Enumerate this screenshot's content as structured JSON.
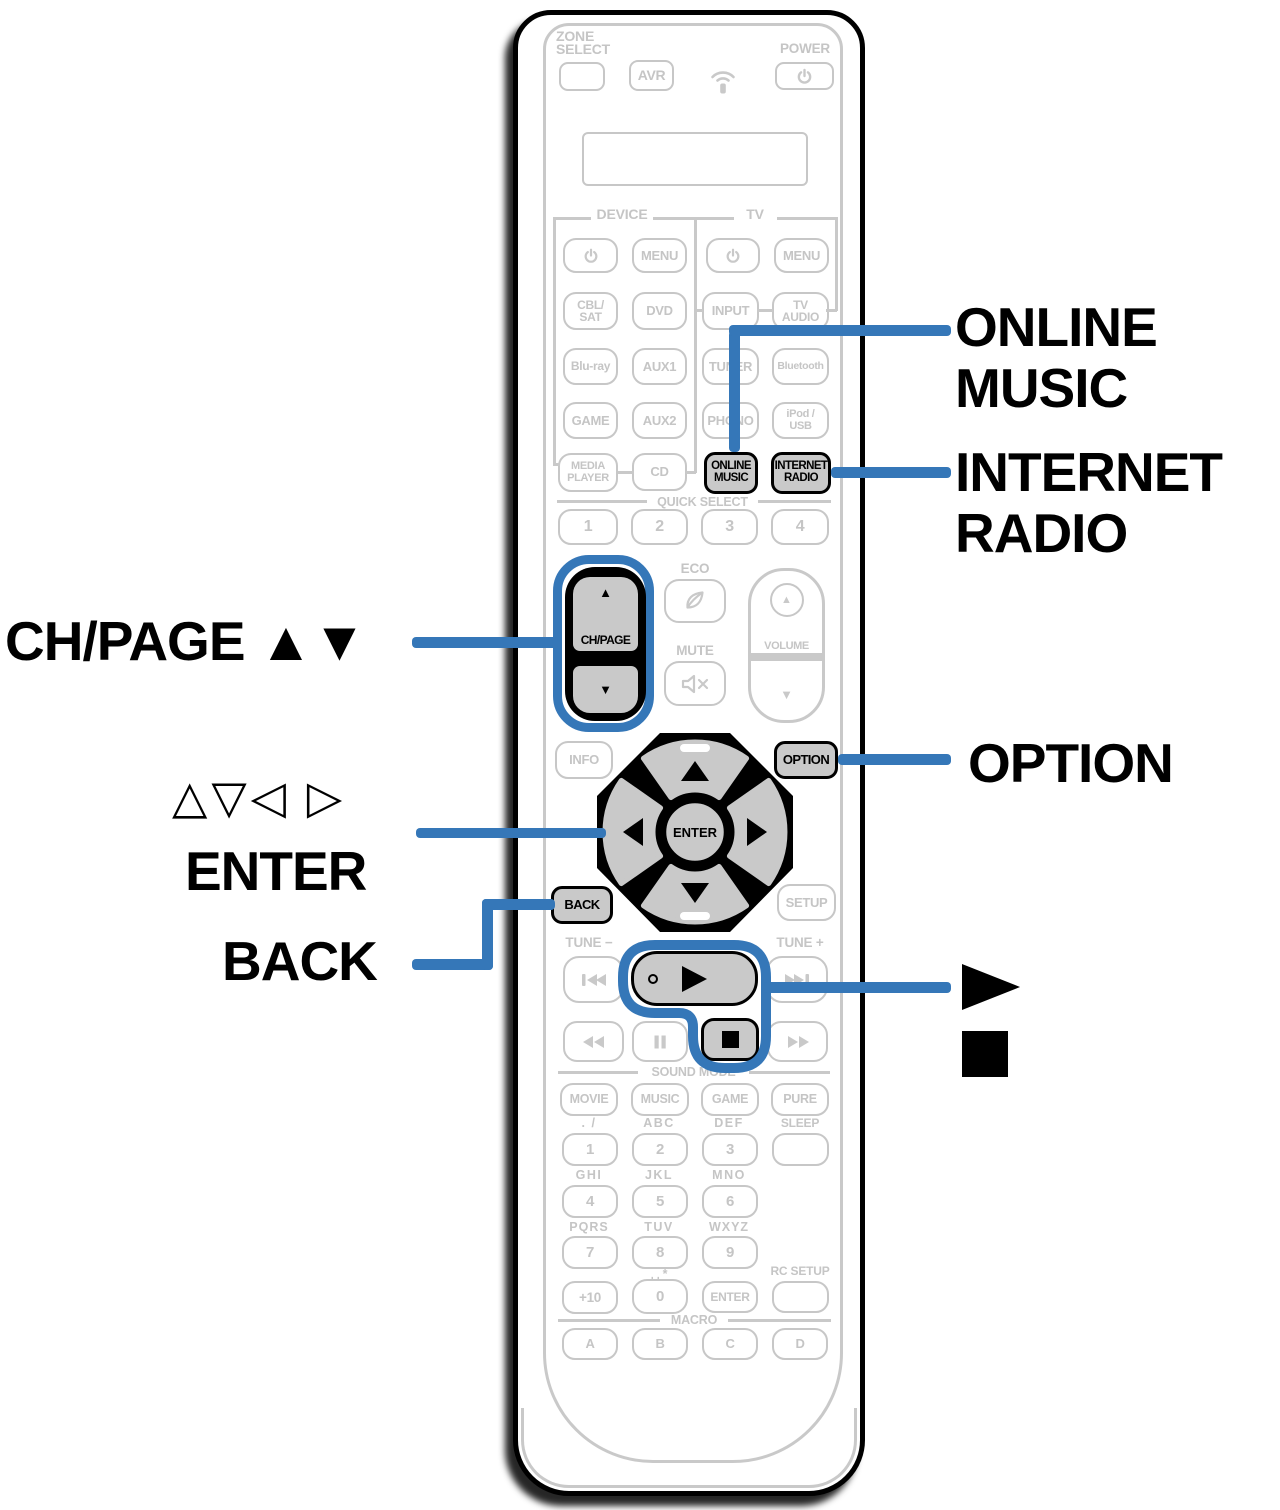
{
  "colors": {
    "callout_blue": "#3577B8",
    "remote_gray": "#c9c9c9",
    "ink": "#000000"
  },
  "callouts": {
    "online_music_l1": "ONLINE",
    "online_music_l2": "MUSIC",
    "internet_radio_l1": "INTERNET",
    "internet_radio_l2": "RADIO",
    "ch_page": "CH/PAGE ▲▼",
    "cursor": "△▽◁ ▷",
    "enter": "ENTER",
    "back": "BACK",
    "option": "OPTION",
    "play": "▶",
    "stop": "■"
  },
  "remote": {
    "zone_select_l1": "ZONE",
    "zone_select_l2": "SELECT",
    "avr": "AVR",
    "power": "POWER",
    "sections": {
      "device": "DEVICE",
      "tv": "TV",
      "quick_select": "QUICK SELECT",
      "sound_mode": "SOUND MODE",
      "macro": "MACRO"
    },
    "device": {
      "menu": "MENU",
      "cbl_l1": "CBL/",
      "cbl_l2": "SAT",
      "dvd": "DVD",
      "bluray": "Blu-ray",
      "aux1": "AUX1",
      "game": "GAME",
      "aux2": "AUX2",
      "media_l1": "MEDIA",
      "media_l2": "PLAYER",
      "cd": "CD"
    },
    "tv": {
      "menu": "MENU",
      "input": "INPUT",
      "tv_audio_l1": "TV",
      "tv_audio_l2": "AUDIO",
      "tuner": "TUNER",
      "bluetooth": "Bluetooth",
      "phono": "PHONO",
      "ipod_l1": "iPod /",
      "ipod_l2": "USB"
    },
    "online_music_l1": "ONLINE",
    "online_music_l2": "MUSIC",
    "internet_radio_l1": "INTERNET",
    "internet_radio_l2": "RADIO",
    "quick_select": {
      "q1": "1",
      "q2": "2",
      "q3": "3",
      "q4": "4"
    },
    "ch_page": {
      "up": "▲",
      "label": "CH/PAGE",
      "down": "▼"
    },
    "eco": "ECO",
    "mute": "MUTE",
    "volume": {
      "label": "VOLUME",
      "up": "▲",
      "down": "▼"
    },
    "info": "INFO",
    "option": "OPTION",
    "setup": "SETUP",
    "back": "BACK",
    "cursor_pad": {
      "enter": "ENTER"
    },
    "tune_minus": "TUNE −",
    "tune_plus": "TUNE +",
    "sound_mode": {
      "movie": "MOVIE",
      "music": "MUSIC",
      "game": "GAME",
      "pure": "PURE"
    },
    "keypad": {
      "r1_letters": [
        ". /",
        "ABC",
        "DEF"
      ],
      "sleep": "SLEEP",
      "n1": "1",
      "n2": "2",
      "n3": "3",
      "r2_letters": [
        "GHI",
        "JKL",
        "MNO"
      ],
      "n4": "4",
      "n5": "5",
      "n6": "6",
      "r3_letters": [
        "PQRS",
        "TUV",
        "WXYZ"
      ],
      "n7": "7",
      "n8": "8",
      "n9": "9",
      "space_star": "␣ *",
      "rc_setup": "RC SETUP",
      "plus10": "+10",
      "n0": "0",
      "enter": "ENTER"
    },
    "macro": {
      "a": "A",
      "b": "B",
      "c": "C",
      "d": "D"
    }
  }
}
